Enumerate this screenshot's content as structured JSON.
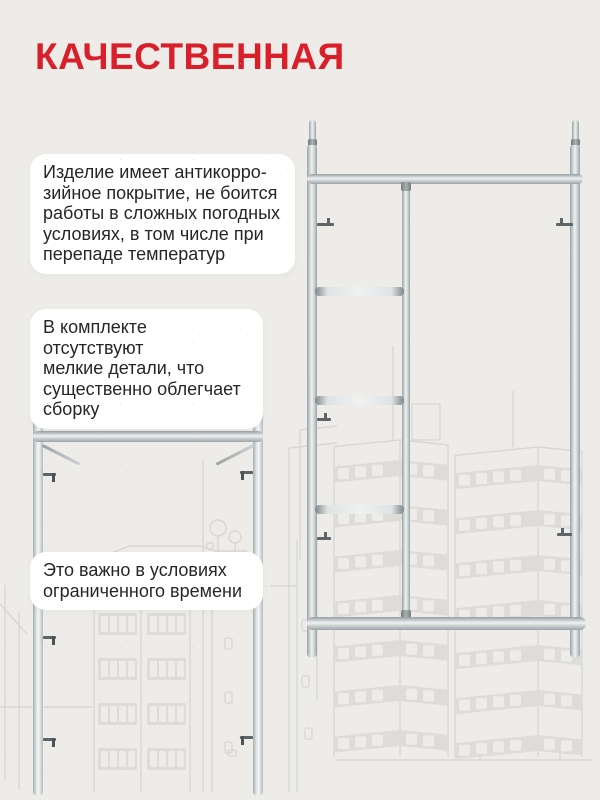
{
  "page": {
    "background_color": "#edece9",
    "accent_red": "#d81f2a",
    "text_color": "#26262a",
    "card_color": "#ffffff",
    "sketch_line_color": "#d8d7d3",
    "metal_color": "#c9d0d1"
  },
  "title": "КАЧЕСТВЕННАЯ",
  "cards": [
    {
      "lines": [
        "Изделие имеет антикорро-",
        "зийное покрытие, не боится",
        "работы в сложных погодных",
        "условиях, в том числе при",
        "перепаде температур"
      ]
    },
    {
      "lines": [
        "В комплекте отсутствуют",
        "мелкие детали, что",
        "существенно облегчает",
        "сборку"
      ]
    },
    {
      "lines": [
        "Это важно в условиях",
        "ограниченного времени"
      ]
    }
  ],
  "photos": {
    "right": "steel-scaffold-ladder-frame-photo",
    "left": "steel-scaffold-frame-top-section-photo"
  },
  "background_art": "light gray line sketch of city high-rise buildings and trees"
}
